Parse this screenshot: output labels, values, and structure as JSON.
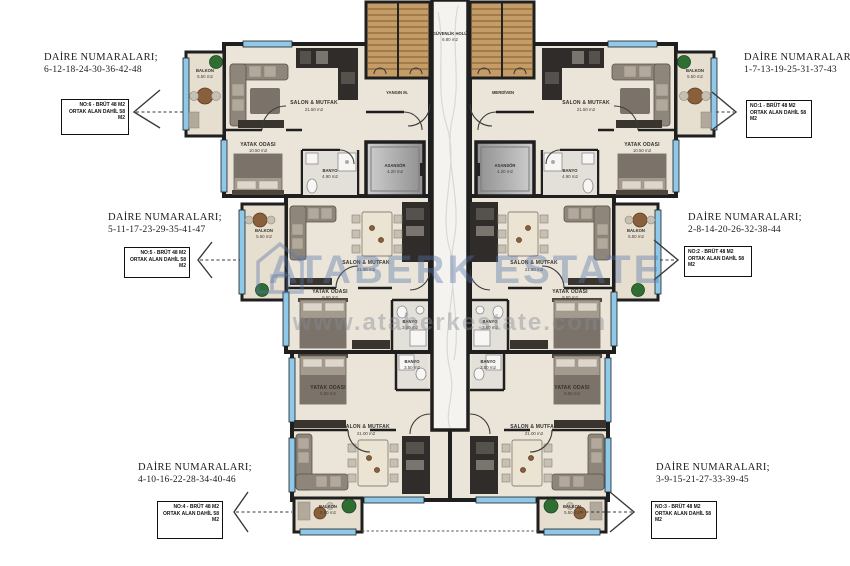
{
  "watermark": {
    "brand": "ATABERK ESTATE",
    "url": "www.ataberkestate.com"
  },
  "core": {
    "guvenlik_name": "GÜVENLİK HOLÜ",
    "guvenlik_area": "6.80 m2",
    "yangin": "YANGIN M.",
    "merdiven": "MERDİVEN",
    "asansor_name": "ASANSÖR",
    "asansor_area": "4.20 m2"
  },
  "units": {
    "tl": {
      "balkon": "BALKON",
      "balkon_area": "5.50 m2",
      "salon": "SALON & MUTFAK",
      "salon_area": "21.50 m2",
      "yatak": "YATAK ODASI",
      "yatak_area": "10.50 m2",
      "banyo": "BANYO",
      "banyo_area": "4.90 m2"
    },
    "tr": {
      "balkon": "BALKON",
      "balkon_area": "5.50 m2",
      "salon": "SALON & MUTFAK",
      "salon_area": "21.50 m2",
      "yatak": "YATAK ODASI",
      "yatak_area": "10.50 m2",
      "banyo": "BANYO",
      "banyo_area": "4.90 m2"
    },
    "ml": {
      "balkon": "BALKON",
      "balkon_area": "5.50 m2",
      "salon": "SALON & MUTFAK",
      "salon_area": "21.80 m2",
      "yatak": "YATAK ODASI",
      "yatak_area": "9.50 m2",
      "banyo": "BANYO",
      "banyo_area": "3.50 m2"
    },
    "mr": {
      "balkon": "BALKON",
      "balkon_area": "5.50 m2",
      "salon": "SALON & MUTFAK",
      "salon_area": "21.80 m2",
      "yatak": "YATAK ODASI",
      "yatak_area": "9.50 m2",
      "banyo": "BANYO",
      "banyo_area": "3.50 m2"
    },
    "bl": {
      "balkon": "BALKON",
      "balkon_area": "5.50 m2",
      "salon": "SALON & MUTFAK",
      "salon_area": "21.00 m2",
      "yatak": "YATAK ODASI",
      "yatak_area": "9.50 m2",
      "banyo": "BANYO",
      "banyo_area": "3.50 m2"
    },
    "br": {
      "balkon": "BALKON",
      "balkon_area": "5.50 m2",
      "salon": "SALON & MUTFAK",
      "salon_area": "21.00 m2",
      "yatak": "YATAK ODASI",
      "yatak_area": "9.50 m2",
      "banyo": "BANYO",
      "banyo_area": "3.50 m2"
    }
  },
  "annotations": [
    {
      "title": "DAİRE NUMARALARI;",
      "numbers": "6-12-18-24-30-36-42-48",
      "box1": "NO:6 - BRÜT 48 M2",
      "box2": "ORTAK ALAN DAHİL 58 M2"
    },
    {
      "title": "DAİRE NUMARALARI;",
      "numbers": "5-11-17-23-29-35-41-47",
      "box1": "NO:5 - BRÜT 48 M2",
      "box2": "ORTAK ALAN DAHİL 58 M2"
    },
    {
      "title": "DAİRE NUMARALARI;",
      "numbers": "4-10-16-22-28-34-40-46",
      "box1": "NO:4 - BRÜT 48 M2",
      "box2": "ORTAK ALAN DAHİL 58 M2"
    },
    {
      "title": "DAİRE NUMARALARI;",
      "numbers": "1-7-13-19-25-31-37-43",
      "box1": "NO:1 - BRÜT 48 M2",
      "box2": "ORTAK ALAN DAHİL 58 M2"
    },
    {
      "title": "DAİRE NUMARALARI;",
      "numbers": "2-8-14-20-26-32-38-44",
      "box1": "NO:2 - BRÜT 48 M2",
      "box2": "ORTAK ALAN DAHİL 58 M2"
    },
    {
      "title": "DAİRE NUMARALARI;",
      "numbers": "3-9-15-21-27-33-39-45",
      "box1": "NO:3 - BRÜT 48 M2",
      "box2": "ORTAK ALAN DAHİL 58 M2"
    }
  ],
  "colors": {
    "wall": "#1f1f1f",
    "floor": "#eae4d9",
    "window": "#8ec9ea",
    "stairs": "#c59c66",
    "watermark_blue": "rgba(88,118,168,0.40)"
  }
}
